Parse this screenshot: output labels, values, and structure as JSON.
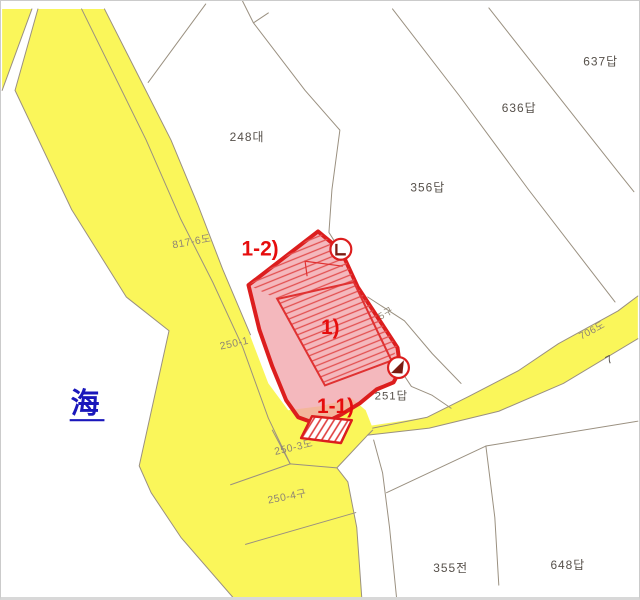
{
  "map": {
    "sea_label": "海",
    "marks": {
      "m1": "1)",
      "m1_1": "1-1)",
      "m1_2": "1-2)"
    },
    "parcel_labels": {
      "p248": "248대",
      "p356": "356답",
      "p636": "636답",
      "p637": "637답",
      "p251": "251답",
      "p355": "355전",
      "p648": "648답",
      "p5gu": "5구",
      "p7": "7"
    },
    "road_labels": {
      "r817_6": "817-6도",
      "r250_1": "250-1",
      "r250_3": "250-3도",
      "r250_4": "250-4구",
      "r706": "706도"
    },
    "colors": {
      "road_fill": "#FAF65A",
      "boundary_line": "#9A9080",
      "parcel_text": "#56504A",
      "road_text": "#8F8574",
      "highlight_stroke": "#DC1E1E",
      "highlight_fill": "#F1A6AC",
      "inner_outline": "#E03232",
      "marker_glyph": "#7C1B12",
      "mark_text": "#E60D0D",
      "sea_text": "#1A17BB"
    }
  }
}
